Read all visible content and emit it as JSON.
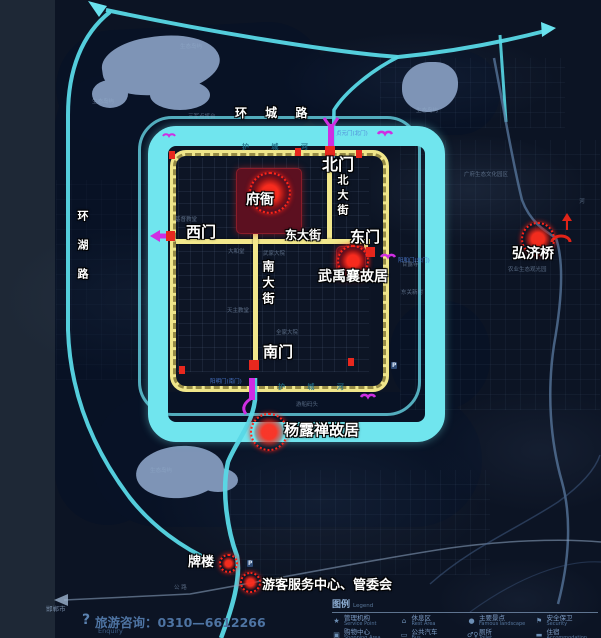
{
  "map": {
    "ring_road": "环 城 路",
    "lake_road": "环湖路",
    "gates": {
      "north": "北门",
      "west": "西门",
      "east": "东门",
      "south": "南门"
    },
    "gate_full_names": {
      "north": "贞元门(北门)",
      "east": "阳和门(东门)",
      "south": "阳明门(南门)"
    },
    "streets": {
      "north": "北大街",
      "east": "东大街",
      "south": "南大街"
    },
    "pois": {
      "fuya": "府衙",
      "wu_yuxiang": "武禹襄故居",
      "yang_luchan": "杨露禅故居",
      "hongji_bridge": "弘济桥",
      "pailou": "牌楼",
      "visitor_center": "游客服务中心、管委会"
    },
    "moat_label_top": "护 城 河",
    "moat_label_bottom": "护 城 河",
    "parking_badge": "P",
    "faint": [
      "生态岛屿",
      "生态岛屿",
      "生态岛屿",
      "生态岛屿",
      "三军点将台",
      "游船码头",
      "基督教堂",
      "大和堂",
      "武家大院",
      "天主教堂",
      "全家大院",
      "东关新村",
      "甘露寺",
      "农业生态观光园",
      "广府生态文化园区",
      "公 路",
      "河",
      "邯郸市"
    ]
  },
  "footer": {
    "question_mark": "?",
    "hotline": "旅游咨询：0310—6612266",
    "hotline_en": "Enquiry"
  },
  "legend": {
    "title": "图例",
    "title_en": "Legend",
    "items": [
      {
        "icon": "★",
        "zh": "管理机构",
        "en": "Service Point"
      },
      {
        "icon": "⌂",
        "zh": "休息区",
        "en": "Rest Area"
      },
      {
        "icon": "●",
        "zh": "主要景点",
        "en": "Famous landscape"
      },
      {
        "icon": "⚑",
        "zh": "安全保卫",
        "en": "Security"
      },
      {
        "icon": "▣",
        "zh": "购物中心",
        "en": "Shopping Area"
      },
      {
        "icon": "▭",
        "zh": "公共汽车",
        "en": "Bus"
      },
      {
        "icon": "♂♀",
        "zh": "厕所",
        "en": "Toilet"
      },
      {
        "icon": "▬",
        "zh": "住宿",
        "en": "Accommodation"
      }
    ]
  },
  "colors": {
    "moat_cyan": "#70e5ee",
    "wall_yellow": "#f0e68a",
    "road_cyan": "#58d8e6",
    "poi_red": "#ff2519",
    "bridge_magenta": "#cf2ee2",
    "water_dark": "#091226",
    "island_blue": "#7e94b6",
    "background": "#0c1424"
  }
}
